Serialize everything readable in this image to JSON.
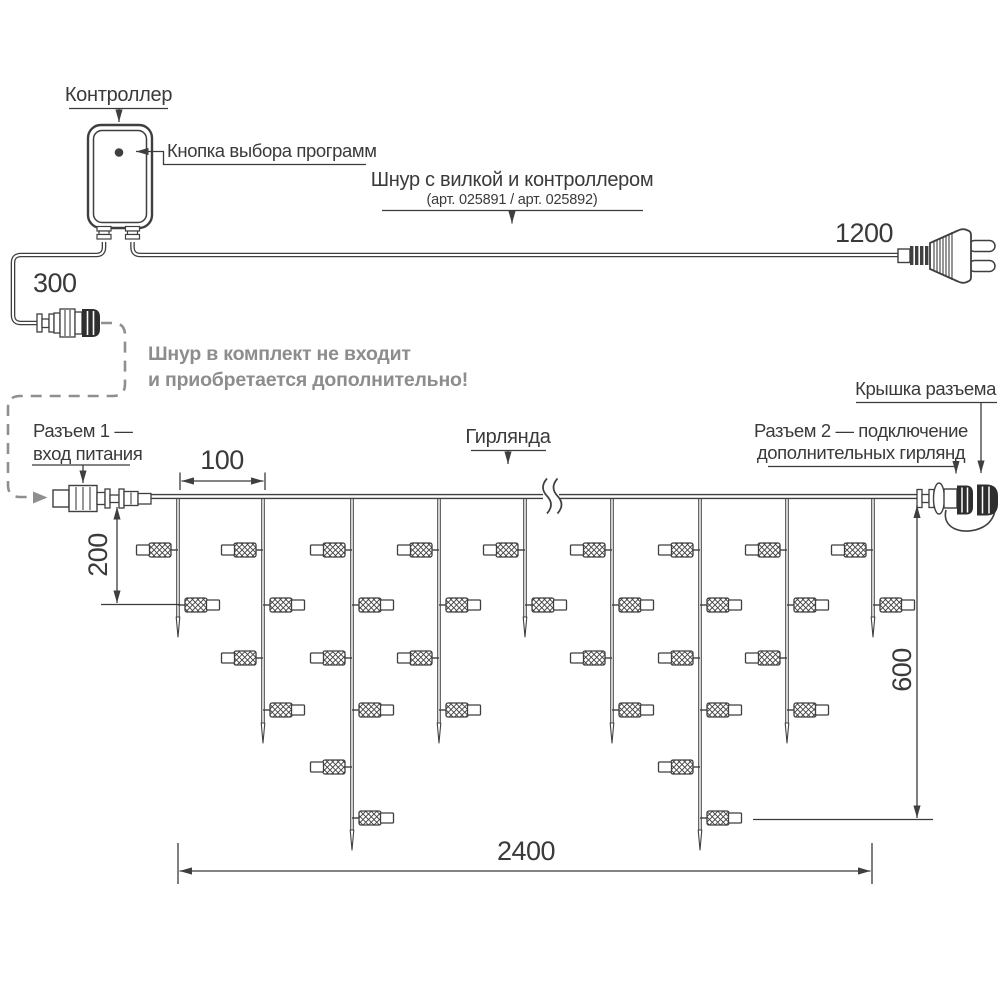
{
  "colors": {
    "line": "#3f3f3f",
    "text": "#3a3a3a",
    "muted": "#8d8d8d",
    "background": "#ffffff"
  },
  "labels": {
    "controller": "Контроллер",
    "program_button": "Кнопка выбора программ",
    "cord_title": "Шнур с вилкой и контроллером",
    "cord_articles": "(арт. 025891 / арт. 025892)",
    "note_line1": "Шнур в комплект не входит",
    "note_line2": "и приобретается дополнительно!",
    "connector1_line1": "Разъем 1 —",
    "connector1_line2": "вход питания",
    "garland": "Гирлянда",
    "connector2_line1": "Разъем 2 — подключение",
    "connector2_line2": "дополнительных гирлянд",
    "connector_cap": "Крышка разъема"
  },
  "dimensions_mm": {
    "lead_in_cord": "300",
    "plug_cord": "1200",
    "drop_pitch": "100",
    "first_drop_length": "200",
    "max_drop_length": "600",
    "garland_width": "2400"
  },
  "garland": {
    "drops": [
      {
        "bulbs": 2
      },
      {
        "bulbs": 4
      },
      {
        "bulbs": 6
      },
      {
        "bulbs": 4
      },
      {
        "bulbs": 2
      },
      {
        "bulbs": 4
      },
      {
        "bulbs": 6
      },
      {
        "bulbs": 4
      },
      {
        "bulbs": 2
      }
    ],
    "bulb_total": 34,
    "wire_break_after_drop": 5
  }
}
